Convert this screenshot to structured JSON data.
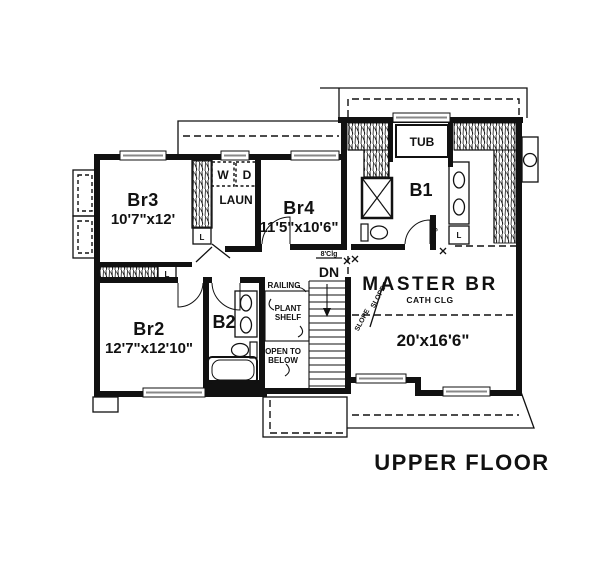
{
  "title": "UPPER FLOOR",
  "rooms": {
    "br3": {
      "name": "Br3",
      "dims": "10'7\"x12'"
    },
    "br2": {
      "name": "Br2",
      "dims": "12'7\"x12'10\""
    },
    "br4": {
      "name": "Br4",
      "dims": "11'5\"x10'6\""
    },
    "master": {
      "name": "MASTER BR",
      "ceiling": "CATH CLG",
      "dims": "20'x16'6\""
    },
    "laundry": {
      "name": "LAUN"
    },
    "bath1": {
      "name": "B1"
    },
    "bath2": {
      "name": "B2"
    }
  },
  "fixtures": {
    "tub": "TUB",
    "washer": "W",
    "dryer": "D",
    "closet": "L"
  },
  "stairs": {
    "down": "DN",
    "railing": "RAILING",
    "plant_shelf_line1": "PLANT",
    "plant_shelf_line2": "SHELF",
    "open_line1": "OPEN TO",
    "open_line2": "BELOW"
  },
  "annotations": {
    "ceiling": "8'Clg",
    "slope": "SLOPE"
  },
  "colors": {
    "line": "#111111",
    "background": "#ffffff"
  }
}
